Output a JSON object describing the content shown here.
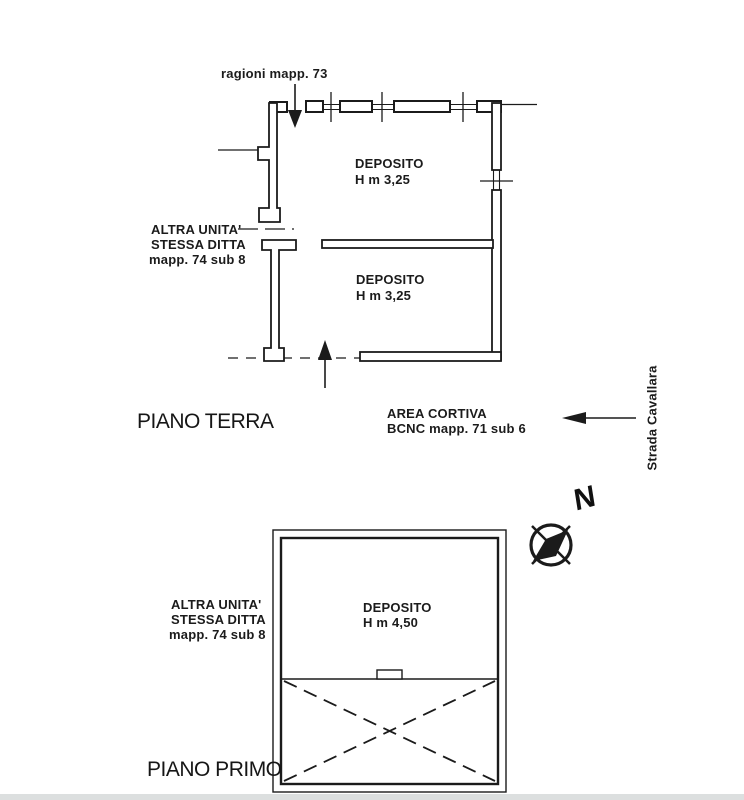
{
  "colors": {
    "ink": "#1b1b1b",
    "paper": "#ffffff",
    "footer_bar": "#dcdfdf"
  },
  "ground_floor": {
    "title": "PIANO TERRA",
    "boundary_label": "ragioni mapp. 73",
    "rooms": [
      {
        "name": "DEPOSITO",
        "height": "H m 3,25"
      },
      {
        "name": "DEPOSITO",
        "height": "H m 3,25"
      }
    ],
    "adjacent_unit": {
      "lines": [
        "ALTRA UNITA'",
        "STESSA DITTA",
        "mapp. 74 sub 8"
      ]
    },
    "courtyard": {
      "lines": [
        "AREA CORTIVA",
        "BCNC mapp. 71 sub 6"
      ]
    },
    "street_name": "Strada Cavallara"
  },
  "first_floor": {
    "title": "PIANO PRIMO",
    "room": {
      "name": "DEPOSITO",
      "height": "H m 4,50"
    },
    "adjacent_unit": {
      "lines": [
        "ALTRA UNITA'",
        "STESSA DITTA",
        "mapp. 74 sub 8"
      ]
    }
  },
  "compass": {
    "north_label": "N"
  }
}
